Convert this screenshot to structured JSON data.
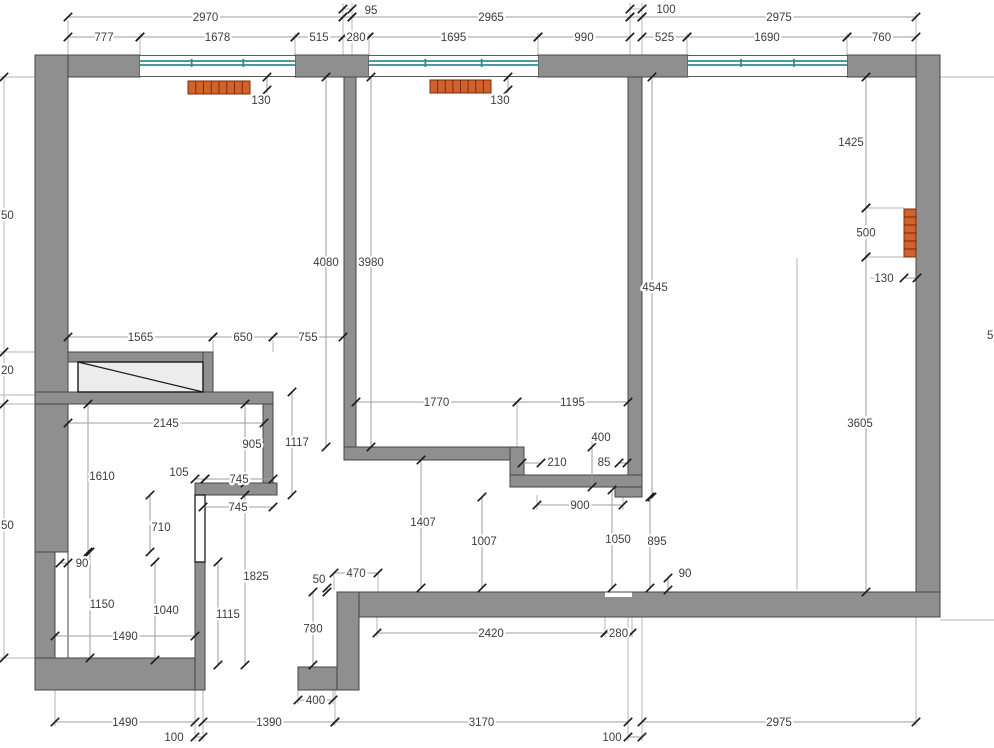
{
  "title": "Apartment floor plan with dimensions",
  "colors": {
    "background": "#ffffff",
    "wall": "#8f8f8f",
    "wall_outline": "#454545",
    "window_glass": "#2e8e8e",
    "radiator": "#d2622c",
    "radiator_outline": "#7c2b0e",
    "dim_line": "#9e9e9e",
    "ext_line": "#b5b5b5",
    "tick": "#1c1c1c",
    "text": "#3c3c3c"
  },
  "plan": {
    "width": 994,
    "height": 748,
    "walls": [
      {
        "x": 35,
        "y": 55,
        "w": 105,
        "h": 22
      },
      {
        "x": 295,
        "y": 55,
        "w": 74,
        "h": 22
      },
      {
        "x": 538,
        "y": 55,
        "w": 150,
        "h": 22
      },
      {
        "x": 847,
        "y": 55,
        "w": 93,
        "h": 22
      },
      {
        "x": 35,
        "y": 55,
        "w": 33,
        "h": 497
      },
      {
        "x": 35,
        "y": 552,
        "w": 20,
        "h": 138
      },
      {
        "x": 344,
        "y": 77,
        "w": 12,
        "h": 383
      },
      {
        "x": 628,
        "y": 77,
        "w": 14,
        "h": 420
      },
      {
        "x": 916,
        "y": 55,
        "w": 24,
        "h": 562
      },
      {
        "x": 68,
        "y": 352,
        "w": 145,
        "h": 10
      },
      {
        "x": 203,
        "y": 352,
        "w": 10,
        "h": 52
      },
      {
        "x": 35,
        "y": 392,
        "w": 238,
        "h": 12
      },
      {
        "x": 263,
        "y": 404,
        "w": 10,
        "h": 79
      },
      {
        "x": 195,
        "y": 483,
        "w": 82,
        "h": 12
      },
      {
        "x": 344,
        "y": 447,
        "w": 166,
        "h": 13
      },
      {
        "x": 510,
        "y": 447,
        "w": 14,
        "h": 40
      },
      {
        "x": 510,
        "y": 475,
        "w": 132,
        "h": 12
      },
      {
        "x": 615,
        "y": 487,
        "w": 27,
        "h": 10
      },
      {
        "x": 337,
        "y": 592,
        "w": 603,
        "h": 25
      },
      {
        "x": 337,
        "y": 592,
        "w": 22,
        "h": 98
      },
      {
        "x": 298,
        "y": 667,
        "w": 39,
        "h": 23
      },
      {
        "x": 35,
        "y": 658,
        "w": 162,
        "h": 32
      },
      {
        "x": 195,
        "y": 562,
        "w": 10,
        "h": 128
      }
    ],
    "white_overlays": [
      {
        "x": 55,
        "y": 552,
        "w": 13,
        "h": 106,
        "stroked": true
      },
      {
        "x": 605,
        "y": 592.5,
        "w": 27,
        "h": 4.5,
        "stroked": false
      }
    ],
    "windows": [
      {
        "x": 140,
        "w": 155
      },
      {
        "x": 369,
        "w": 169
      },
      {
        "x": 688,
        "w": 159
      }
    ],
    "window_band": {
      "top": 55,
      "bottom": 77,
      "glass1": 61,
      "glass2": 65
    },
    "radiators": [
      {
        "x": 188,
        "y": 81,
        "w": 62,
        "h": 13,
        "segments": 8,
        "vertical": false
      },
      {
        "x": 430,
        "y": 80,
        "w": 61,
        "h": 13,
        "segments": 8,
        "vertical": false
      },
      {
        "x": 904,
        "y": 209,
        "w": 12,
        "h": 48,
        "segments": 6,
        "vertical": true
      }
    ],
    "wardrobe": {
      "x": 78,
      "y": 362,
      "w": 125,
      "h": 30
    },
    "thin_partition": {
      "x": 195,
      "y": 495,
      "w": 10,
      "h": 67
    },
    "dims": [
      {
        "o": "h",
        "c": 17,
        "a": 68,
        "b": 343,
        "t": "2970"
      },
      {
        "o": "h",
        "c": 17,
        "a": 352,
        "b": 630,
        "t": "2965"
      },
      {
        "o": "h",
        "c": 17,
        "a": 642,
        "b": 916,
        "t": "2975"
      },
      {
        "o": "h",
        "c": 17,
        "a": 343,
        "b": 352,
        "t": "95",
        "lx": 371,
        "ly": 14
      },
      {
        "o": "h",
        "c": 17,
        "a": 630,
        "b": 642,
        "t": "100",
        "lx": 666,
        "ly": 13
      },
      {
        "o": "h",
        "c": 37,
        "a": 68,
        "b": 140,
        "t": "777"
      },
      {
        "o": "h",
        "c": 37,
        "a": 140,
        "b": 295,
        "t": "1678"
      },
      {
        "o": "h",
        "c": 37,
        "a": 295,
        "b": 343,
        "t": "515"
      },
      {
        "o": "h",
        "c": 37,
        "a": 343,
        "b": 369,
        "t": "280"
      },
      {
        "o": "h",
        "c": 37,
        "a": 369,
        "b": 538,
        "t": "1695"
      },
      {
        "o": "h",
        "c": 37,
        "a": 538,
        "b": 630,
        "t": "990"
      },
      {
        "o": "h",
        "c": 37,
        "a": 642,
        "b": 687,
        "t": "525"
      },
      {
        "o": "h",
        "c": 37,
        "a": 687,
        "b": 847,
        "t": "1690"
      },
      {
        "o": "h",
        "c": 37,
        "a": 847,
        "b": 916,
        "t": "760"
      },
      {
        "o": "h",
        "c": 337,
        "a": 68,
        "b": 213,
        "t": "1565"
      },
      {
        "o": "h",
        "c": 337,
        "a": 213,
        "b": 273,
        "t": "650"
      },
      {
        "o": "h",
        "c": 337,
        "a": 273,
        "b": 343,
        "t": "755"
      },
      {
        "o": "h",
        "c": 402,
        "a": 356,
        "b": 517,
        "t": "1770"
      },
      {
        "o": "h",
        "c": 402,
        "a": 517,
        "b": 628,
        "t": "1195"
      },
      {
        "o": "h",
        "c": 423,
        "a": 68,
        "b": 264,
        "t": "2145"
      },
      {
        "o": "h",
        "c": 463,
        "a": 522,
        "b": 541,
        "t": "210",
        "lx": 557,
        "ly": 466
      },
      {
        "o": "h",
        "c": 463,
        "a": 619,
        "b": 627,
        "t": "85",
        "lx": 604,
        "ly": 466
      },
      {
        "o": "h",
        "c": 479,
        "a": 195,
        "b": 205,
        "t": "105",
        "lx": 179,
        "ly": 476
      },
      {
        "o": "h",
        "c": 479,
        "a": 205,
        "b": 273,
        "t": "745"
      },
      {
        "o": "h",
        "c": 507,
        "a": 203,
        "b": 273,
        "t": "745"
      },
      {
        "o": "h",
        "c": 505,
        "a": 537,
        "b": 623,
        "t": "900"
      },
      {
        "o": "h",
        "c": 563,
        "a": 60,
        "b": 68,
        "t": "90",
        "lx": 82,
        "ly": 567
      },
      {
        "o": "h",
        "c": 573,
        "a": 334,
        "b": 378,
        "t": "470"
      },
      {
        "o": "h",
        "c": 636,
        "a": 55,
        "b": 195,
        "t": "1490"
      },
      {
        "o": "h",
        "c": 633,
        "a": 377,
        "b": 605,
        "t": "2420"
      },
      {
        "o": "h",
        "c": 633,
        "a": 605,
        "b": 632,
        "t": "280"
      },
      {
        "o": "h",
        "c": 700,
        "a": 298,
        "b": 333,
        "t": "400"
      },
      {
        "o": "h",
        "c": 722,
        "a": 55,
        "b": 195,
        "t": "1490"
      },
      {
        "o": "h",
        "c": 722,
        "a": 203,
        "b": 335,
        "t": "1390"
      },
      {
        "o": "h",
        "c": 722,
        "a": 335,
        "b": 628,
        "t": "3170"
      },
      {
        "o": "h",
        "c": 722,
        "a": 642,
        "b": 916,
        "t": "2975"
      },
      {
        "o": "h",
        "c": 737,
        "a": 195,
        "b": 203,
        "t": "100",
        "lx": 174,
        "ly": 741
      },
      {
        "o": "h",
        "c": 737,
        "a": 628,
        "b": 642,
        "t": "100",
        "lx": 612,
        "ly": 741
      },
      {
        "o": "h",
        "c": 278,
        "a": 904,
        "b": 917,
        "t": "130",
        "lx": 884,
        "ly": 282
      },
      {
        "o": "v",
        "c": 326,
        "a": 77,
        "b": 447,
        "t": "4080"
      },
      {
        "o": "v",
        "c": 371,
        "a": 77,
        "b": 447,
        "t": "3980"
      },
      {
        "o": "v",
        "c": 652,
        "a": 77,
        "b": 497,
        "t": "4545",
        "lx": 655,
        "ly": 291
      },
      {
        "o": "v",
        "c": 866,
        "a": 77,
        "b": 208,
        "t": "1425",
        "lx": 851,
        "ly": 146
      },
      {
        "o": "v",
        "c": 866,
        "a": 208,
        "b": 257,
        "t": "500"
      },
      {
        "o": "v",
        "c": 866,
        "a": 257,
        "b": 592,
        "t": "3605",
        "lx": 860,
        "ly": 427
      },
      {
        "o": "v",
        "c": 292,
        "a": 392,
        "b": 495,
        "t": "1117",
        "lx": 297,
        "ly": 446
      },
      {
        "o": "v",
        "c": 245,
        "a": 404,
        "b": 483,
        "t": "905",
        "lx": 252,
        "ly": 448
      },
      {
        "o": "v",
        "c": 88,
        "a": 404,
        "b": 552,
        "t": "1610",
        "lx": 102,
        "ly": 480
      },
      {
        "o": "v",
        "c": 150,
        "a": 495,
        "b": 552,
        "t": "710",
        "lx": 161,
        "ly": 531
      },
      {
        "o": "v",
        "c": 245,
        "a": 495,
        "b": 665,
        "t": "1825",
        "lx": 256,
        "ly": 580
      },
      {
        "o": "v",
        "c": 218,
        "a": 562,
        "b": 665,
        "t": "1115",
        "lx": 228,
        "ly": 618
      },
      {
        "o": "v",
        "c": 155,
        "a": 562,
        "b": 660,
        "t": "1040",
        "lx": 166,
        "ly": 614
      },
      {
        "o": "v",
        "c": 90,
        "a": 552,
        "b": 658,
        "t": "1150",
        "lx": 102,
        "ly": 608
      },
      {
        "o": "v",
        "c": 421,
        "a": 460,
        "b": 588,
        "t": "1407",
        "lx": 423,
        "ly": 526
      },
      {
        "o": "v",
        "c": 482,
        "a": 497,
        "b": 588,
        "t": "1007",
        "lx": 484,
        "ly": 545
      },
      {
        "o": "v",
        "c": 612,
        "a": 490,
        "b": 588,
        "t": "1050",
        "lx": 618,
        "ly": 543
      },
      {
        "o": "v",
        "c": 650,
        "a": 497,
        "b": 588,
        "t": "895",
        "lx": 657,
        "ly": 545
      },
      {
        "o": "v",
        "c": 668,
        "a": 578,
        "b": 590,
        "t": "90",
        "lx": 685,
        "ly": 577
      },
      {
        "o": "v",
        "c": 592,
        "a": 447,
        "b": 487,
        "t": "400",
        "lx": 601,
        "ly": 441
      },
      {
        "o": "v",
        "c": 313,
        "a": 592,
        "b": 665,
        "t": "780"
      },
      {
        "o": "v",
        "c": 327,
        "a": 588,
        "b": 592,
        "t": "50",
        "lx": 319,
        "ly": 583
      },
      {
        "o": "v",
        "c": 267,
        "a": 77,
        "b": 90,
        "t": "130",
        "lx": 261,
        "ly": 104
      },
      {
        "o": "v",
        "c": 508,
        "a": 77,
        "b": 90,
        "t": "130",
        "lx": 500,
        "ly": 104
      }
    ],
    "ext_lines": [
      [
        68,
        20,
        68,
        58
      ],
      [
        140,
        33,
        140,
        58
      ],
      [
        295,
        33,
        295,
        58
      ],
      [
        343,
        3,
        343,
        58
      ],
      [
        352,
        3,
        352,
        58
      ],
      [
        369,
        33,
        369,
        60
      ],
      [
        538,
        33,
        538,
        58
      ],
      [
        630,
        3,
        630,
        58
      ],
      [
        642,
        3,
        642,
        58
      ],
      [
        687,
        33,
        687,
        58
      ],
      [
        847,
        33,
        847,
        58
      ],
      [
        916,
        12,
        916,
        58
      ],
      [
        342,
        9,
        353,
        9
      ],
      [
        629,
        9,
        643,
        9
      ],
      [
        0,
        77,
        68,
        77
      ],
      [
        940,
        77,
        994,
        77
      ],
      [
        940,
        620,
        994,
        620
      ],
      [
        0,
        352,
        35,
        352
      ],
      [
        0,
        395,
        35,
        395
      ],
      [
        0,
        404,
        35,
        404
      ],
      [
        0,
        658,
        35,
        658
      ],
      [
        4,
        77,
        4,
        658
      ],
      [
        68,
        337,
        68,
        352
      ],
      [
        213,
        340,
        213,
        352
      ],
      [
        273,
        340,
        273,
        352
      ],
      [
        356,
        402,
        356,
        449
      ],
      [
        517,
        402,
        517,
        449
      ],
      [
        628,
        402,
        628,
        449
      ],
      [
        537,
        495,
        537,
        510
      ],
      [
        623,
        495,
        623,
        510
      ],
      [
        592,
        436,
        592,
        449
      ],
      [
        267,
        90,
        267,
        103
      ],
      [
        508,
        90,
        508,
        103
      ],
      [
        870,
        278,
        896,
        278
      ],
      [
        866,
        208,
        904,
        208
      ],
      [
        866,
        257,
        904,
        257
      ],
      [
        797,
        258,
        797,
        590
      ],
      [
        334,
        573,
        334,
        590
      ],
      [
        378,
        573,
        378,
        592
      ],
      [
        377,
        617,
        377,
        637
      ],
      [
        605,
        597,
        605,
        637
      ],
      [
        632,
        597,
        632,
        637
      ],
      [
        333,
        690,
        333,
        704
      ],
      [
        298,
        690,
        298,
        704
      ],
      [
        55,
        658,
        55,
        726
      ],
      [
        195,
        690,
        195,
        741
      ],
      [
        203,
        690,
        203,
        741
      ],
      [
        335,
        690,
        335,
        726
      ],
      [
        628,
        617,
        628,
        741
      ],
      [
        642,
        617,
        642,
        741
      ],
      [
        916,
        617,
        916,
        726
      ]
    ],
    "extra_ticks": [
      [
        4,
        77
      ],
      [
        4,
        352
      ],
      [
        4,
        404
      ],
      [
        4,
        658
      ],
      [
        343,
        9
      ],
      [
        352,
        9
      ],
      [
        630,
        9
      ],
      [
        642,
        9
      ]
    ],
    "cut_labels": [
      {
        "t": "50",
        "x": 1,
        "y": 219
      },
      {
        "t": "20",
        "x": 1,
        "y": 374
      },
      {
        "t": "50",
        "x": 1,
        "y": 529
      },
      {
        "t": "5",
        "x": 987,
        "y": 339
      }
    ]
  }
}
